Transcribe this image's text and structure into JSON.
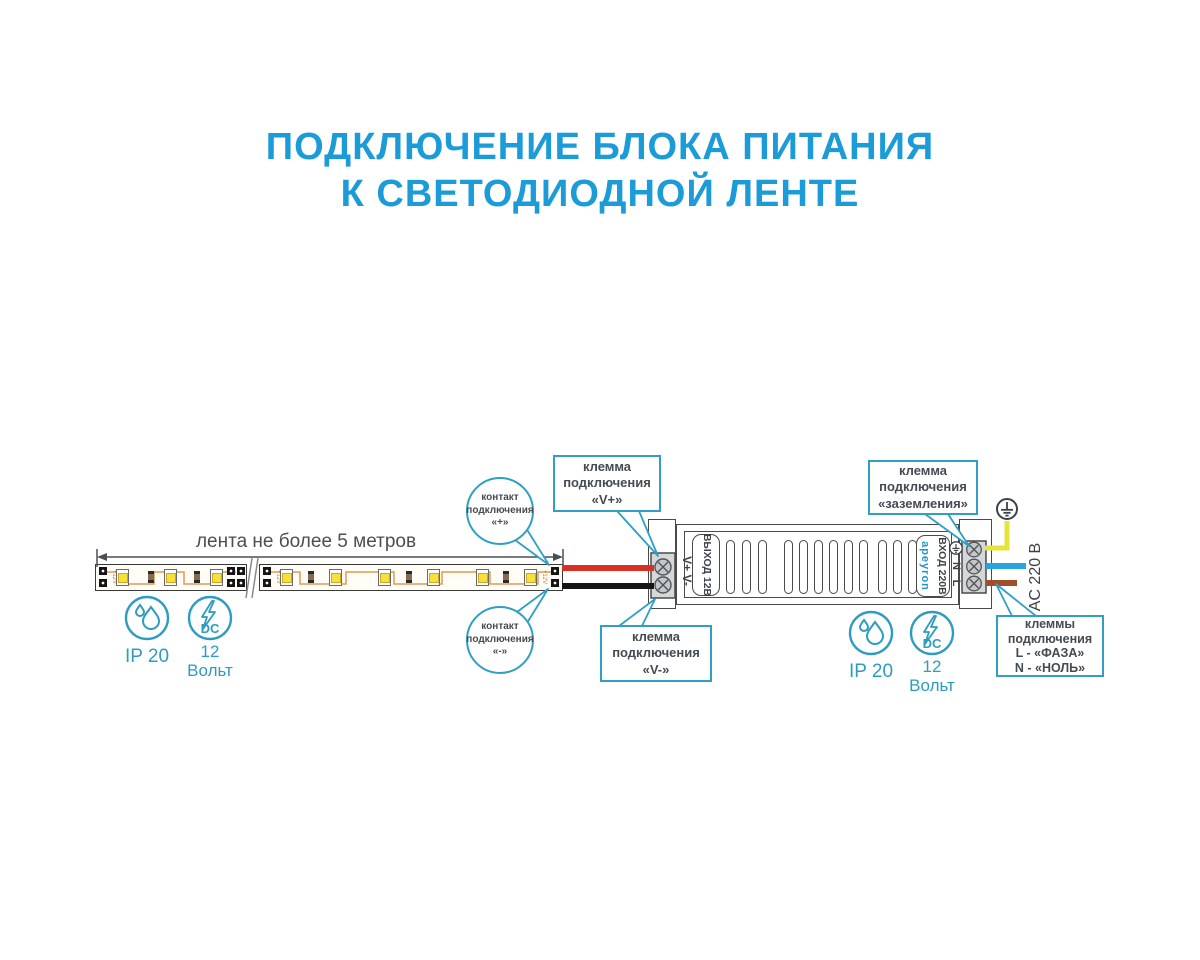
{
  "title": {
    "line1": "ПОДКЛЮЧЕНИЕ БЛОКА ПИТАНИЯ",
    "line2": "К СВЕТОДИОДНОЙ ЛЕНТЕ"
  },
  "strip": {
    "dimension_label": "лента не более 5 метров",
    "pad_marking": "+12V"
  },
  "callouts": {
    "contact_plus": "контакт\nподключения\n«+»",
    "contact_minus": "контакт\nподключения\n«-»",
    "terminal_vplus": "клемма\nподключения\n«V+»",
    "terminal_vminus": "клемма\nподключения\n«V-»",
    "terminal_ground": "клемма\nподключения\n«заземления»",
    "terminal_mains": "клеммы\nподключения\nL - «ФАЗА»\nN - «НОЛЬ»"
  },
  "psu": {
    "brand": "apeyron",
    "output_label": "ВЫХОД 12В",
    "input_label": "ВХОД 220В",
    "dc_terminals": "V+ V-",
    "n_label": "N",
    "l_label": "L",
    "ac_label": "AC 220 В"
  },
  "badges": {
    "ip_label": "IP 20",
    "dc_value": "12",
    "dc_unit": "Вольт",
    "dc_text": "DC"
  },
  "colors": {
    "accent_blue": "#1b9bd8",
    "callout_teal": "#2f9fc4",
    "badge_teal": "#2d9cbf",
    "wire_red": "#d93025",
    "wire_black": "#151515",
    "wire_ground_yellow": "#e4e43c",
    "wire_neutral_blue": "#2aa3df",
    "wire_live_brown": "#a04f2a"
  }
}
